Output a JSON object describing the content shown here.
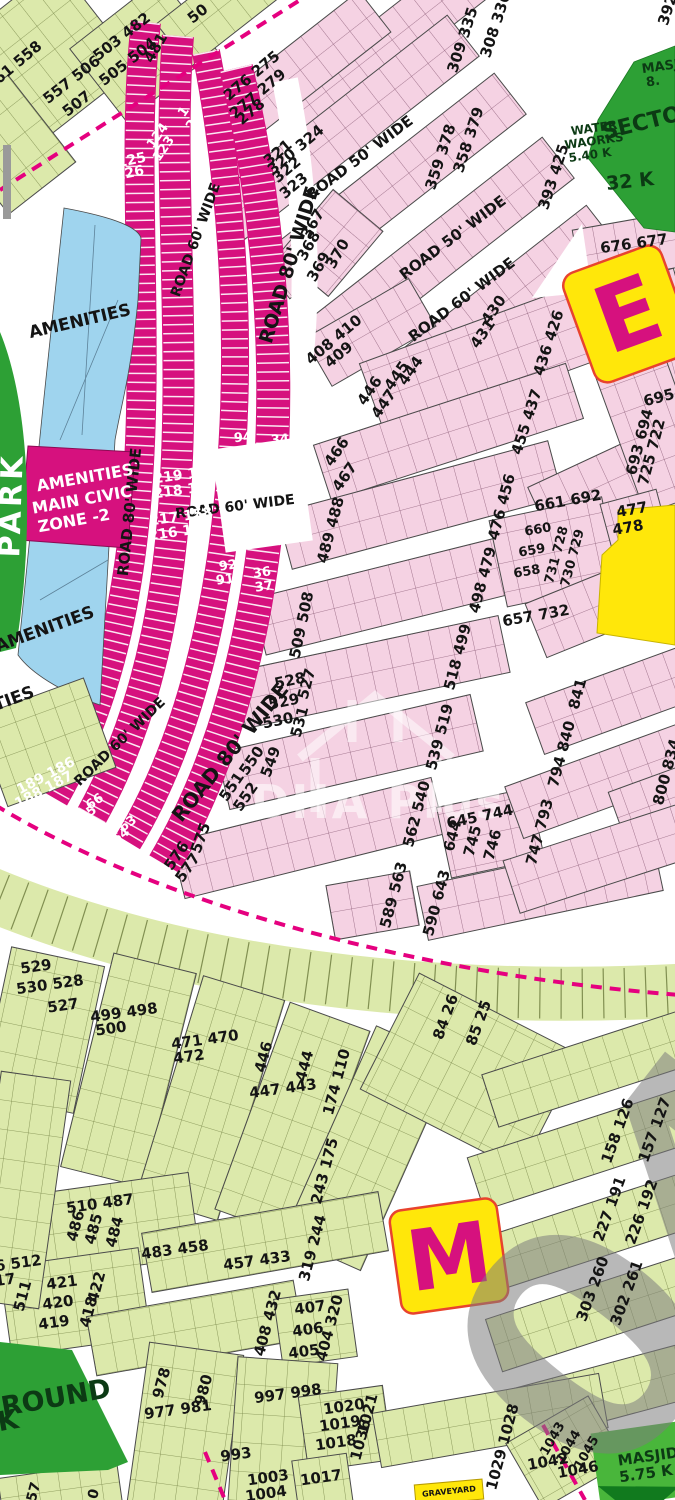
{
  "title": "Housing scheme plot map",
  "palette": {
    "pink_plot": "#f5d2e3",
    "pink_line": "#8c5d77",
    "lime_plot": "#dce9ab",
    "lime_line": "#778547",
    "magenta_band": "#d6117e",
    "dashed_boundary": "#e5007f",
    "blue_amenities": "#9fd4ee",
    "green_area": "#2da035",
    "yellow_block": "#ffe70a",
    "yellow_border": "#e8432e",
    "watermark_gray": "#8a8a8a"
  },
  "markers": {
    "e_block": "E",
    "m_block": "M"
  },
  "watermark": {
    "logo_text": "DHA Plus",
    "big_digits": "04"
  },
  "labels": {
    "roads": [
      {
        "t": "ROAD 50' WIDE",
        "x": 360,
        "y": 158,
        "r": -37,
        "s": 15
      },
      {
        "t": "ROAD 50' WIDE",
        "x": 453,
        "y": 238,
        "r": -37,
        "s": 15
      },
      {
        "t": "ROAD 60' WIDE",
        "x": 462,
        "y": 300,
        "r": -37,
        "s": 15
      },
      {
        "t": "ROAD 80' WIDE",
        "x": 290,
        "y": 265,
        "r": -73,
        "s": 19
      },
      {
        "t": "ROAD 60' WIDE",
        "x": 196,
        "y": 240,
        "r": -70,
        "s": 14
      },
      {
        "t": "ROAD 80' WIDE",
        "x": 130,
        "y": 512,
        "r": -84,
        "s": 15
      },
      {
        "t": "ROAD 60' WIDE",
        "x": 235,
        "y": 507,
        "r": -7,
        "s": 14
      },
      {
        "t": "ROAD 60' WIDE",
        "x": 120,
        "y": 742,
        "r": -44,
        "s": 14
      },
      {
        "t": "ROAD 80' WIDE",
        "x": 230,
        "y": 752,
        "r": -51,
        "s": 20
      }
    ],
    "arc_plots": [
      {
        "t": "1",
        "x": 184,
        "y": 112,
        "r": -55,
        "s": 13,
        "c": "w"
      },
      {
        "t": "2",
        "x": 192,
        "y": 125,
        "r": -55,
        "s": 13,
        "c": "w"
      },
      {
        "t": "124",
        "x": 158,
        "y": 136,
        "r": -55,
        "s": 13,
        "c": "w"
      },
      {
        "t": "123",
        "x": 164,
        "y": 149,
        "r": -55,
        "s": 13,
        "c": "w"
      },
      {
        "t": "94",
        "x": 243,
        "y": 438,
        "r": -5,
        "s": 13,
        "c": "w"
      },
      {
        "t": "93",
        "x": 243,
        "y": 452,
        "r": -5,
        "s": 13,
        "c": "w"
      },
      {
        "t": "34",
        "x": 280,
        "y": 440,
        "r": -5,
        "s": 13,
        "c": "w"
      },
      {
        "t": "35",
        "x": 282,
        "y": 455,
        "r": -5,
        "s": 13,
        "c": "w"
      },
      {
        "t": "92",
        "x": 228,
        "y": 566,
        "r": -8,
        "s": 13,
        "c": "w"
      },
      {
        "t": "91",
        "x": 225,
        "y": 580,
        "r": -8,
        "s": 13,
        "c": "w"
      },
      {
        "t": "36",
        "x": 262,
        "y": 573,
        "r": -8,
        "s": 13,
        "c": "w"
      },
      {
        "t": "37",
        "x": 264,
        "y": 587,
        "r": -8,
        "s": 13,
        "c": "w"
      },
      {
        "t": "66",
        "x": 95,
        "y": 802,
        "r": -35,
        "s": 13,
        "c": "w"
      },
      {
        "t": "65",
        "x": 88,
        "y": 814,
        "r": -35,
        "s": 13,
        "c": "w"
      },
      {
        "t": "63",
        "x": 128,
        "y": 824,
        "r": -35,
        "s": 13,
        "c": "w"
      },
      {
        "t": "64",
        "x": 121,
        "y": 836,
        "r": -35,
        "s": 13,
        "c": "w"
      },
      {
        "t": "249 125",
        "x": 115,
        "y": 164,
        "r": -12,
        "s": 14
      },
      {
        "t": "248 126",
        "x": 113,
        "y": 177,
        "r": -12,
        "s": 14
      },
      {
        "t": "219 156",
        "x": 185,
        "y": 475,
        "r": -8,
        "s": 14
      },
      {
        "t": "218 157",
        "x": 185,
        "y": 490,
        "r": -8,
        "s": 14
      },
      {
        "t": "217 158",
        "x": 181,
        "y": 517,
        "r": -8,
        "s": 14
      },
      {
        "t": "216 159",
        "x": 180,
        "y": 532,
        "r": -8,
        "s": 14
      },
      {
        "t": "189 186",
        "x": 46,
        "y": 776,
        "r": -28,
        "s": 14
      },
      {
        "t": "188 187",
        "x": 44,
        "y": 790,
        "r": -28,
        "s": 14
      }
    ],
    "plots": [
      {
        "t": "561 558",
        "x": 14,
        "y": 66,
        "r": -40
      },
      {
        "t": "503 482",
        "x": 122,
        "y": 37,
        "r": -38
      },
      {
        "t": "505 504",
        "x": 128,
        "y": 62,
        "r": -38
      },
      {
        "t": "481",
        "x": 156,
        "y": 48,
        "r": -60
      },
      {
        "t": "557 506",
        "x": 72,
        "y": 80,
        "r": -38
      },
      {
        "t": "507",
        "x": 77,
        "y": 104,
        "r": -38
      },
      {
        "t": "50",
        "x": 198,
        "y": 14,
        "r": -38
      },
      {
        "t": "276 275",
        "x": 252,
        "y": 76,
        "r": -40
      },
      {
        "t": "277 279",
        "x": 258,
        "y": 94,
        "r": -40
      },
      {
        "t": "278",
        "x": 251,
        "y": 112,
        "r": -40
      },
      {
        "t": "320 324",
        "x": 296,
        "y": 150,
        "r": -40
      },
      {
        "t": "321",
        "x": 278,
        "y": 153,
        "r": -40
      },
      {
        "t": "322",
        "x": 287,
        "y": 170,
        "r": -40
      },
      {
        "t": "323",
        "x": 294,
        "y": 186,
        "r": -40
      },
      {
        "t": "309 335",
        "x": 463,
        "y": 40,
        "r": -72
      },
      {
        "t": "308 336",
        "x": 496,
        "y": 25,
        "r": -72
      },
      {
        "t": "392",
        "x": 668,
        "y": 10,
        "r": -72
      },
      {
        "t": "358 379",
        "x": 469,
        "y": 140,
        "r": -72
      },
      {
        "t": "359 378",
        "x": 441,
        "y": 157,
        "r": -72
      },
      {
        "t": "393 425",
        "x": 554,
        "y": 177,
        "r": -72
      },
      {
        "t": "367",
        "x": 313,
        "y": 224,
        "r": -60
      },
      {
        "t": "368",
        "x": 309,
        "y": 246,
        "r": -60
      },
      {
        "t": "369",
        "x": 319,
        "y": 267,
        "r": -60
      },
      {
        "t": "370",
        "x": 338,
        "y": 254,
        "r": -60
      },
      {
        "t": "408 410",
        "x": 334,
        "y": 340,
        "r": -40
      },
      {
        "t": "409",
        "x": 339,
        "y": 355,
        "r": -40
      },
      {
        "t": "431",
        "x": 483,
        "y": 334,
        "r": -55
      },
      {
        "t": "430",
        "x": 494,
        "y": 310,
        "r": -55
      },
      {
        "t": "436 426",
        "x": 549,
        "y": 343,
        "r": -72
      },
      {
        "t": "446",
        "x": 370,
        "y": 391,
        "r": -55
      },
      {
        "t": "447",
        "x": 384,
        "y": 404,
        "r": -55
      },
      {
        "t": "445",
        "x": 397,
        "y": 376,
        "r": -55
      },
      {
        "t": "444",
        "x": 411,
        "y": 371,
        "r": -55
      },
      {
        "t": "455 437",
        "x": 527,
        "y": 422,
        "r": -72
      },
      {
        "t": "466",
        "x": 337,
        "y": 452,
        "r": -55
      },
      {
        "t": "467",
        "x": 345,
        "y": 477,
        "r": -55
      },
      {
        "t": "489 488",
        "x": 331,
        "y": 530,
        "r": -75
      },
      {
        "t": "476 456",
        "x": 502,
        "y": 507,
        "r": -75
      },
      {
        "t": "509 508",
        "x": 302,
        "y": 625,
        "r": -78
      },
      {
        "t": "498 479",
        "x": 483,
        "y": 580,
        "r": -75
      },
      {
        "t": "528",
        "x": 290,
        "y": 681,
        "r": -12
      },
      {
        "t": "527",
        "x": 307,
        "y": 684,
        "r": -75
      },
      {
        "t": "529",
        "x": 284,
        "y": 702,
        "r": -12
      },
      {
        "t": "530",
        "x": 278,
        "y": 721,
        "r": -12
      },
      {
        "t": "531",
        "x": 300,
        "y": 722,
        "r": -75
      },
      {
        "t": "518 499",
        "x": 458,
        "y": 657,
        "r": -75
      },
      {
        "t": "551",
        "x": 232,
        "y": 787,
        "r": -55
      },
      {
        "t": "552",
        "x": 246,
        "y": 797,
        "r": -55
      },
      {
        "t": "550",
        "x": 252,
        "y": 761,
        "r": -55
      },
      {
        "t": "549",
        "x": 271,
        "y": 762,
        "r": -70
      },
      {
        "t": "539 519",
        "x": 440,
        "y": 737,
        "r": -75
      },
      {
        "t": "576",
        "x": 177,
        "y": 856,
        "r": -55
      },
      {
        "t": "577",
        "x": 188,
        "y": 868,
        "r": -55
      },
      {
        "t": "575",
        "x": 201,
        "y": 838,
        "r": -70
      },
      {
        "t": "562 540",
        "x": 417,
        "y": 814,
        "r": -75
      },
      {
        "t": "645 744",
        "x": 480,
        "y": 817,
        "r": -12
      },
      {
        "t": "644",
        "x": 453,
        "y": 836,
        "r": -75
      },
      {
        "t": "745",
        "x": 473,
        "y": 841,
        "r": -75
      },
      {
        "t": "746",
        "x": 493,
        "y": 845,
        "r": -75
      },
      {
        "t": "589 563",
        "x": 394,
        "y": 895,
        "r": -75
      },
      {
        "t": "590 643",
        "x": 437,
        "y": 903,
        "r": -75
      },
      {
        "t": "747 793",
        "x": 540,
        "y": 832,
        "r": -75
      },
      {
        "t": "794 840",
        "x": 562,
        "y": 754,
        "r": -75
      },
      {
        "t": "800 834",
        "x": 667,
        "y": 772,
        "r": -75
      },
      {
        "t": "841",
        "x": 578,
        "y": 694,
        "r": -75
      },
      {
        "t": "657 732",
        "x": 536,
        "y": 616,
        "r": -10
      },
      {
        "t": "661 692",
        "x": 568,
        "y": 501,
        "r": -10
      },
      {
        "t": "660",
        "x": 538,
        "y": 530,
        "r": -10,
        "s": 13
      },
      {
        "t": "659",
        "x": 532,
        "y": 551,
        "r": -10,
        "s": 13
      },
      {
        "t": "658",
        "x": 527,
        "y": 572,
        "r": -10,
        "s": 13
      },
      {
        "t": "731 728",
        "x": 557,
        "y": 555,
        "r": -75,
        "s": 13
      },
      {
        "t": "730 729",
        "x": 573,
        "y": 558,
        "r": -75,
        "s": 13
      },
      {
        "t": "477",
        "x": 632,
        "y": 510,
        "r": -10
      },
      {
        "t": "478",
        "x": 628,
        "y": 528,
        "r": -10
      },
      {
        "t": "695",
        "x": 659,
        "y": 398,
        "r": -15
      },
      {
        "t": "693 694",
        "x": 640,
        "y": 442,
        "r": -75
      },
      {
        "t": "725 722",
        "x": 652,
        "y": 452,
        "r": -75
      },
      {
        "t": "676 677",
        "x": 634,
        "y": 244,
        "r": -8
      },
      {
        "t": "529",
        "x": 36,
        "y": 967,
        "r": -8
      },
      {
        "t": "530 528",
        "x": 50,
        "y": 985,
        "r": -8
      },
      {
        "t": "527",
        "x": 63,
        "y": 1006,
        "r": -8
      },
      {
        "t": "499 498",
        "x": 124,
        "y": 1013,
        "r": -8
      },
      {
        "t": "500",
        "x": 111,
        "y": 1029,
        "r": -8
      },
      {
        "t": "471 470",
        "x": 205,
        "y": 1040,
        "r": -8
      },
      {
        "t": "472",
        "x": 189,
        "y": 1057,
        "r": -8
      },
      {
        "t": "446",
        "x": 264,
        "y": 1057,
        "r": -75
      },
      {
        "t": "444",
        "x": 305,
        "y": 1066,
        "r": -75
      },
      {
        "t": "447 443",
        "x": 283,
        "y": 1089,
        "r": -8
      },
      {
        "t": "174 110",
        "x": 337,
        "y": 1082,
        "r": -75
      },
      {
        "t": "84 26",
        "x": 446,
        "y": 1017,
        "r": -70
      },
      {
        "t": "85 25",
        "x": 479,
        "y": 1023,
        "r": -70
      },
      {
        "t": "243 175",
        "x": 325,
        "y": 1171,
        "r": -75
      },
      {
        "t": "158 126",
        "x": 618,
        "y": 1131,
        "r": -70
      },
      {
        "t": "157 127",
        "x": 655,
        "y": 1130,
        "r": -70
      },
      {
        "t": "227 191",
        "x": 610,
        "y": 1209,
        "r": -70
      },
      {
        "t": "226 192",
        "x": 642,
        "y": 1212,
        "r": -70
      },
      {
        "t": "303 260",
        "x": 593,
        "y": 1289,
        "r": -70
      },
      {
        "t": "302 261",
        "x": 627,
        "y": 1293,
        "r": -70
      },
      {
        "t": "510 487",
        "x": 100,
        "y": 1204,
        "r": -8
      },
      {
        "t": "486",
        "x": 76,
        "y": 1226,
        "r": -75
      },
      {
        "t": "485",
        "x": 94,
        "y": 1229,
        "r": -75
      },
      {
        "t": "484",
        "x": 115,
        "y": 1232,
        "r": -75
      },
      {
        "t": "483 458",
        "x": 175,
        "y": 1250,
        "r": -8
      },
      {
        "t": "457 433",
        "x": 257,
        "y": 1261,
        "r": -8
      },
      {
        "t": "319 244",
        "x": 313,
        "y": 1248,
        "r": -75
      },
      {
        "t": "516 512",
        "x": 8,
        "y": 1265,
        "r": -8
      },
      {
        "t": "517",
        "x": 0,
        "y": 1281,
        "r": -8
      },
      {
        "t": "511",
        "x": 23,
        "y": 1296,
        "r": -75
      },
      {
        "t": "421",
        "x": 62,
        "y": 1283,
        "r": -8
      },
      {
        "t": "420",
        "x": 58,
        "y": 1303,
        "r": -8
      },
      {
        "t": "419",
        "x": 54,
        "y": 1323,
        "r": -8
      },
      {
        "t": "422",
        "x": 97,
        "y": 1287,
        "r": -75
      },
      {
        "t": "418",
        "x": 89,
        "y": 1312,
        "r": -75
      },
      {
        "t": "408 432",
        "x": 268,
        "y": 1323,
        "r": -75
      },
      {
        "t": "407",
        "x": 310,
        "y": 1308,
        "r": -8
      },
      {
        "t": "406",
        "x": 308,
        "y": 1330,
        "r": -8
      },
      {
        "t": "405",
        "x": 304,
        "y": 1352,
        "r": -8
      },
      {
        "t": "404 320",
        "x": 330,
        "y": 1328,
        "r": -75
      },
      {
        "t": "978",
        "x": 162,
        "y": 1383,
        "r": -75
      },
      {
        "t": "980",
        "x": 204,
        "y": 1390,
        "r": -75
      },
      {
        "t": "977 981",
        "x": 178,
        "y": 1410,
        "r": -8
      },
      {
        "t": "997 998",
        "x": 288,
        "y": 1394,
        "r": -8
      },
      {
        "t": "993",
        "x": 236,
        "y": 1455,
        "r": -8
      },
      {
        "t": "1003",
        "x": 268,
        "y": 1478,
        "r": -8
      },
      {
        "t": "1004",
        "x": 266,
        "y": 1494,
        "r": -8
      },
      {
        "t": "1017",
        "x": 321,
        "y": 1478,
        "r": -8
      },
      {
        "t": "1020",
        "x": 344,
        "y": 1407,
        "r": -8
      },
      {
        "t": "1019",
        "x": 340,
        "y": 1424,
        "r": -8
      },
      {
        "t": "1018",
        "x": 336,
        "y": 1443,
        "r": -8
      },
      {
        "t": "1021",
        "x": 368,
        "y": 1414,
        "r": -75
      },
      {
        "t": "1036",
        "x": 361,
        "y": 1440,
        "r": -75
      },
      {
        "t": "1029 1028",
        "x": 503,
        "y": 1447,
        "r": -75
      },
      {
        "t": "1043",
        "x": 553,
        "y": 1439,
        "r": -60,
        "s": 13
      },
      {
        "t": "1044",
        "x": 569,
        "y": 1447,
        "r": -60,
        "s": 13
      },
      {
        "t": "1045",
        "x": 587,
        "y": 1453,
        "r": -60,
        "s": 13
      },
      {
        "t": "1042",
        "x": 548,
        "y": 1462,
        "r": -10
      },
      {
        "t": "1046",
        "x": 578,
        "y": 1470,
        "r": -10
      },
      {
        "t": "57",
        "x": 34,
        "y": 1492,
        "r": -75,
        "s": 14
      },
      {
        "t": "0",
        "x": 94,
        "y": 1494,
        "r": -75,
        "s": 14
      }
    ],
    "areas": [
      {
        "t": "AMENITIES",
        "x": 80,
        "y": 322,
        "r": -13,
        "s": 17
      },
      {
        "t": "AMENITIES",
        "x": 85,
        "y": 478,
        "r": -10,
        "s": 16,
        "c": "w"
      },
      {
        "t": "MAIN CIVIC",
        "x": 82,
        "y": 500,
        "r": -10,
        "s": 16,
        "c": "w"
      },
      {
        "t": "ZONE -2",
        "x": 74,
        "y": 521,
        "r": -10,
        "s": 16,
        "c": "w"
      },
      {
        "t": "AMENITIES",
        "x": 45,
        "y": 630,
        "r": -20,
        "s": 17
      },
      {
        "t": "AMENITIES",
        "x": -15,
        "y": 710,
        "r": -20,
        "s": 17
      },
      {
        "t": "PARK",
        "x": 12,
        "y": 505,
        "r": -88,
        "s": 30,
        "c": "w",
        "k": "park"
      },
      {
        "t": "SECTOR",
        "x": 650,
        "y": 122,
        "r": -14,
        "s": 22,
        "c": "dg"
      },
      {
        "t": "32 K",
        "x": 630,
        "y": 182,
        "r": -6,
        "s": 19,
        "c": "dg"
      },
      {
        "t": "WATER",
        "x": 594,
        "y": 128,
        "r": -8,
        "s": 12,
        "c": "dg"
      },
      {
        "t": "WAORKS",
        "x": 594,
        "y": 141,
        "r": -8,
        "s": 12,
        "c": "dg"
      },
      {
        "t": "5.40 K",
        "x": 590,
        "y": 155,
        "r": -8,
        "s": 12,
        "c": "dg"
      },
      {
        "t": "MASJID",
        "x": 668,
        "y": 66,
        "r": -8,
        "s": 13,
        "c": "dg"
      },
      {
        "t": "8.",
        "x": 653,
        "y": 82,
        "r": -8,
        "s": 13,
        "c": "dg"
      },
      {
        "t": "MASJID",
        "x": 648,
        "y": 1457,
        "r": -8,
        "s": 15,
        "c": "dg"
      },
      {
        "t": "5.75 K",
        "x": 646,
        "y": 1474,
        "r": -8,
        "s": 15,
        "c": "dg"
      },
      {
        "t": "GRAVEYARD",
        "x": 449,
        "y": 1492,
        "r": -6,
        "s": 8
      },
      {
        "t": "GROUND",
        "x": 45,
        "y": 1400,
        "r": -10,
        "s": 27,
        "c": "dg"
      },
      {
        "t": "K",
        "x": 8,
        "y": 1421,
        "r": -10,
        "s": 27,
        "c": "dg"
      }
    ]
  }
}
